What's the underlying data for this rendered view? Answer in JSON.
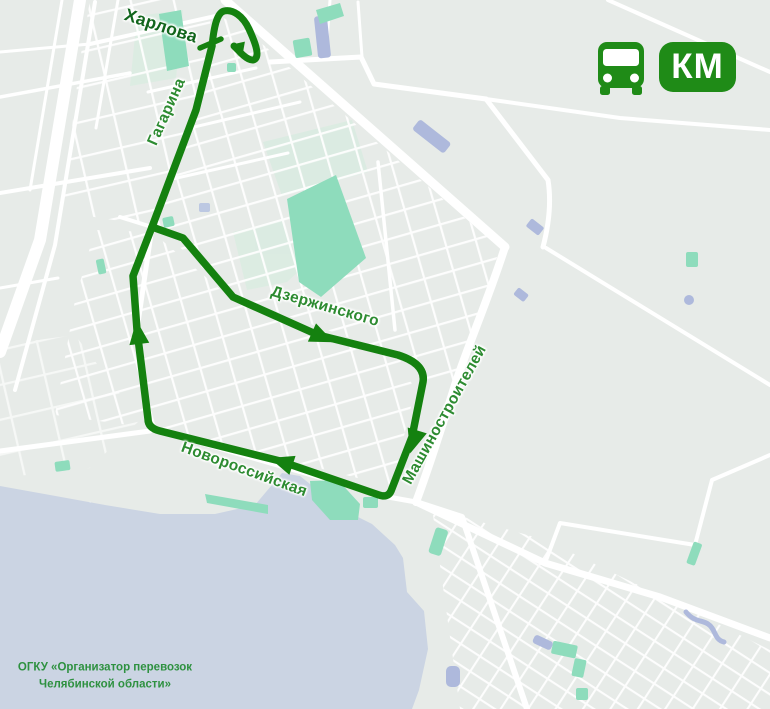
{
  "header": {
    "badge": "КМ",
    "icon": "bus-icon"
  },
  "streets": {
    "kharlova": "Харлова",
    "gagarina": "Гагарина",
    "dzerzhinskogo": "Дзержинского",
    "mashinostroitelei": "Машиностроителей",
    "novorossiyskaya": "Новороссийская"
  },
  "attribution": {
    "line1": "ОГКУ «Организатор перевозок",
    "line2": "Челябинской области»"
  },
  "colors": {
    "route": "#14810f",
    "badge": "#1f8b17",
    "street_label": "#2d8b31",
    "terminal_label": "#11651c",
    "background": "#e7ebe8",
    "water": "#cbd4e3",
    "pond": "#aeb9dc",
    "park": "#8edcbc",
    "road": "#ffffff",
    "attribution": "#2e9140"
  }
}
